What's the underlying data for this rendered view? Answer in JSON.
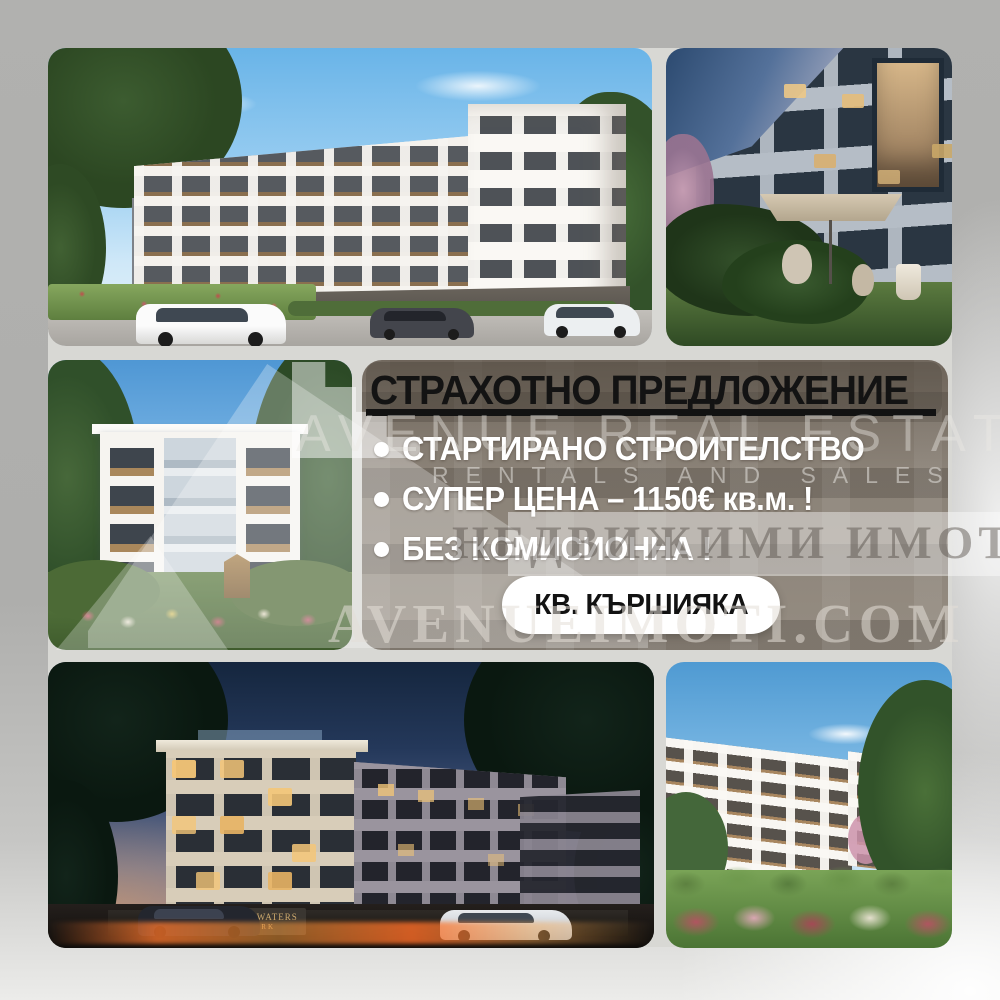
{
  "offer": {
    "title": "СТРАХОТНО ПРЕДЛОЖЕНИЕ",
    "bullet_glyph": "•",
    "bullets": [
      {
        "text": "СТАРТИРАНО СТРОИТЕЛСТВО"
      },
      {
        "text": "СУПЕР ЦЕНА – 1150€ кв.м. !"
      },
      {
        "text": "БЕЗ КОМИСИОННА !"
      }
    ],
    "location_badge": "КВ. КЪРШИЯКА"
  },
  "watermarks": {
    "agency_name": "AVENUE REAL ESTATE",
    "agency_tagline": "RENTALS AND SALES",
    "agency_cyrillic": "НЕДВИЖИМИ ИМОТИ",
    "website": "AVENUEIMOTI.COM"
  },
  "photos": {
    "top_left": {
      "sign_line1": "BLUE WATERS",
      "sign_line2": "PARK"
    },
    "bottom_left": {
      "sign_line1": "BLUE WATERS",
      "sign_line2": "PARK"
    }
  },
  "colors": {
    "background_gray": "#b0b0ae",
    "band_dim_taupe": "#948b80",
    "text_black": "#131313",
    "text_white": "#ffffff",
    "badge_bg": "#ffffff",
    "day_sky": "#69b4e8",
    "night_sky": "#15263e",
    "lit_window": "#f4c678",
    "light_streak_orange": "#ff7828"
  }
}
